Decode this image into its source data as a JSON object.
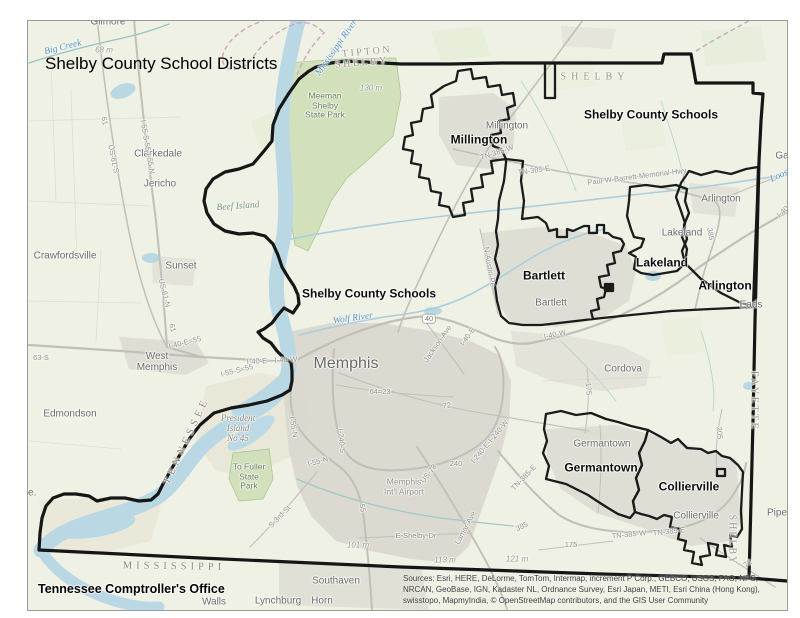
{
  "title": "Shelby County School Districts",
  "attribution": "Tennessee Comptroller's Office",
  "sources": {
    "lines": [
      "Sources: Esri, HERE, DeLorme, TomTom, Intermap, increment P Corp., GEBCO, USGS, FAO, NPS,",
      "NRCAN, GeoBase, IGN, Kadaster NL, Ordnance Survey, Esri Japan, METI, Esri China (Hong Kong),",
      "swisstopo, MapmyIndia, © OpenStreetMap contributors, and the GIS User Community"
    ]
  },
  "colors": {
    "land": "#eef1e4",
    "water": "#b9d8e3",
    "urban": "#d8d5ce",
    "park": "#cfe0b8",
    "boundary": "#161616",
    "road": "#c2bfb8",
    "county_dash": "#c9a8bc",
    "district_label": "#0c0c0c",
    "city_label": "#696967",
    "water_label": "#4d8cba"
  },
  "map": {
    "labels": {
      "districts": [
        {
          "t": "Shelby County Schools",
          "x": 650,
          "y": 114,
          "n": "district-label-shelby-county-schools-north"
        },
        {
          "t": "Millington",
          "x": 478,
          "y": 139,
          "n": "district-label-millington"
        },
        {
          "t": "Bartlett",
          "x": 543,
          "y": 275,
          "n": "district-label-bartlett"
        },
        {
          "t": "Lakeland",
          "x": 661,
          "y": 262,
          "n": "district-label-lakeland"
        },
        {
          "t": "Arlington",
          "x": 724,
          "y": 285,
          "n": "district-label-arlington"
        },
        {
          "t": "Shelby County Schools",
          "x": 368,
          "y": 293,
          "n": "district-label-shelby-county-schools-central"
        },
        {
          "t": "Germantown",
          "x": 600,
          "y": 467,
          "n": "district-label-germantown"
        },
        {
          "t": "Collierville",
          "x": 688,
          "y": 486,
          "n": "district-label-collierville"
        }
      ],
      "cities": [
        {
          "t": "Gilmore",
          "x": 107,
          "y": 21
        },
        {
          "t": "Clarkedale",
          "x": 157,
          "y": 153
        },
        {
          "t": "Jericho",
          "x": 159,
          "y": 183
        },
        {
          "t": "Crawfordsville",
          "x": 64,
          "y": 255
        },
        {
          "t": "Sunset",
          "x": 180,
          "y": 265
        },
        {
          "t": "West\nMemphis",
          "x": 156,
          "y": 361
        },
        {
          "t": "Memphis",
          "x": 345,
          "y": 363,
          "fs": 16,
          "n": "city-label-memphis"
        },
        {
          "t": "Millington",
          "x": 506,
          "y": 125
        },
        {
          "t": "Bartlett",
          "x": 550,
          "y": 302
        },
        {
          "t": "Lakeland",
          "x": 681,
          "y": 232
        },
        {
          "t": "Arlington",
          "x": 720,
          "y": 198
        },
        {
          "t": "Cordova",
          "x": 622,
          "y": 368
        },
        {
          "t": "Germantown",
          "x": 601,
          "y": 443
        },
        {
          "t": "Collierville",
          "x": 695,
          "y": 515
        },
        {
          "t": "Eads",
          "x": 750,
          "y": 304
        },
        {
          "t": "Ga",
          "x": 781,
          "y": 155
        },
        {
          "t": "Pipe",
          "x": 776,
          "y": 512
        },
        {
          "t": "Edmondson",
          "x": 69,
          "y": 413
        },
        {
          "t": "Southaven",
          "x": 335,
          "y": 580
        },
        {
          "t": "Walls",
          "x": 213,
          "y": 601
        },
        {
          "t": "Lynchburg",
          "x": 277,
          "y": 600
        },
        {
          "t": "Horn",
          "x": 321,
          "y": 600
        },
        {
          "t": "lle.",
          "x": 29,
          "y": 492
        }
      ],
      "counties": [
        {
          "t": "TIPTON",
          "x": 366,
          "y": 51,
          "rot": -5,
          "n": "county-label-tipton"
        },
        {
          "t": "SHELBY",
          "x": 361,
          "y": 62,
          "rot": -5,
          "n": "county-label-shelby-nw"
        },
        {
          "t": "SHELBY",
          "x": 594,
          "y": 76,
          "ls": 5,
          "n": "county-label-shelby-top"
        },
        {
          "t": "FAYETTE",
          "x": 753,
          "y": 400,
          "rot": 90,
          "n": "county-label-fayette"
        },
        {
          "t": "SHELBY",
          "x": 731,
          "y": 539,
          "rot": 90,
          "ls": 2,
          "n": "county-label-shelby-se"
        }
      ],
      "states": [
        {
          "t": "TENNESSEE",
          "x": 186,
          "y": 440,
          "rot": -65,
          "n": "state-label-tennessee"
        },
        {
          "t": "MISSISSIPPI",
          "x": 173,
          "y": 566,
          "rot": 1,
          "n": "state-label-mississippi"
        }
      ],
      "water": [
        {
          "t": "Mississippi River",
          "x": 336,
          "y": 47,
          "rot": -55,
          "n": "water-label-mississippi-river"
        },
        {
          "t": "Wolf River",
          "x": 352,
          "y": 318,
          "rot": -8,
          "n": "water-label-wolf-river"
        },
        {
          "t": "Big Creek",
          "x": 62,
          "y": 47,
          "rot": -14,
          "n": "water-label-big-creek"
        },
        {
          "t": "Loosahat",
          "x": 786,
          "y": 172,
          "rot": -25,
          "n": "water-label-loosahatchie"
        }
      ],
      "green": [
        {
          "t": "Beef Island",
          "x": 237,
          "y": 206,
          "rot": -4,
          "n": "area-label-beef-island"
        }
      ],
      "parks": [
        {
          "t": "Meeman\nShelby\nState Park",
          "x": 324,
          "y": 105,
          "n": "park-label-meeman-shelby"
        },
        {
          "t": "To Fuller\nState\nPark",
          "x": 248,
          "y": 476,
          "n": "park-label-to-fuller"
        }
      ],
      "islands": [
        {
          "t": "President\nIsland\nNo 45",
          "x": 237,
          "y": 427,
          "n": "island-label-president-island"
        }
      ],
      "airports": [
        {
          "t": "Memphis\nInt'l Airport",
          "x": 403,
          "y": 486,
          "n": "airport-label-memphis-intl"
        }
      ],
      "elevations": [
        {
          "t": "68 m",
          "x": 103,
          "y": 50
        },
        {
          "t": "130 m",
          "x": 370,
          "y": 88
        },
        {
          "t": "101 m",
          "x": 357,
          "y": 545
        },
        {
          "t": "113 m",
          "x": 444,
          "y": 560
        },
        {
          "t": "121 m",
          "x": 516,
          "y": 559
        }
      ],
      "roads": [
        {
          "t": "61",
          "x": 103,
          "y": 120,
          "rot": 78
        },
        {
          "t": "US-61-S",
          "x": 112,
          "y": 158,
          "rot": 78
        },
        {
          "t": "I-55-S-55-I-55-N",
          "x": 146,
          "y": 146,
          "rot": 80
        },
        {
          "t": "US-61-N",
          "x": 163,
          "y": 292,
          "rot": 76
        },
        {
          "t": "61",
          "x": 171,
          "y": 327,
          "rot": 76
        },
        {
          "t": "I-40-E=55",
          "x": 184,
          "y": 342,
          "rot": -14
        },
        {
          "t": "I-55-S=55",
          "x": 236,
          "y": 370,
          "rot": -14
        },
        {
          "t": "I-40-E—I-40-W",
          "x": 271,
          "y": 360,
          "rot": -3
        },
        {
          "t": "63-S",
          "x": 40,
          "y": 357
        },
        {
          "t": "Jackson-Ave",
          "x": 437,
          "y": 343,
          "rot": -55
        },
        {
          "t": "I-40-E",
          "x": 467,
          "y": 336,
          "rot": -55
        },
        {
          "t": "I-40-W",
          "x": 554,
          "y": 334,
          "rot": -12
        },
        {
          "t": "N-Austin-Pe",
          "x": 488,
          "y": 266,
          "rot": 80
        },
        {
          "t": "TN-385-W",
          "x": 496,
          "y": 152,
          "rot": -18
        },
        {
          "t": "TN-385-E",
          "x": 533,
          "y": 170,
          "rot": -8
        },
        {
          "t": "Paul-W-Barrett-Memorial-Hwy",
          "x": 636,
          "y": 176,
          "rot": -7
        },
        {
          "t": "385",
          "x": 709,
          "y": 233,
          "rot": 80
        },
        {
          "t": "I-40",
          "x": 782,
          "y": 211,
          "rot": -40
        },
        {
          "t": "64=23",
          "x": 379,
          "y": 391
        },
        {
          "t": "72",
          "x": 446,
          "y": 405,
          "rot": -8
        },
        {
          "t": "I-240-S",
          "x": 340,
          "y": 440,
          "rot": 85
        },
        {
          "t": "I-55-N",
          "x": 292,
          "y": 426,
          "rot": 80
        },
        {
          "t": "I-55-N",
          "x": 317,
          "y": 461,
          "rot": -16
        },
        {
          "t": "55",
          "x": 361,
          "y": 507,
          "rot": 80
        },
        {
          "t": "S-3rd-St",
          "x": 279,
          "y": 516,
          "rot": -46
        },
        {
          "t": "US-78",
          "x": 428,
          "y": 473,
          "rot": -52
        },
        {
          "t": "240",
          "x": 455,
          "y": 463
        },
        {
          "t": "I-240-E-I-240-W",
          "x": 489,
          "y": 441,
          "rot": -50
        },
        {
          "t": "TN-385-E",
          "x": 523,
          "y": 477,
          "rot": -46
        },
        {
          "t": "Lamar-Ave",
          "x": 465,
          "y": 527,
          "rot": -62
        },
        {
          "t": "E-Shelby-Dr",
          "x": 415,
          "y": 535
        },
        {
          "t": "385",
          "x": 521,
          "y": 526,
          "rot": -24
        },
        {
          "t": "TN-385-W",
          "x": 628,
          "y": 534,
          "rot": -6
        },
        {
          "t": "TN-385-E",
          "x": 668,
          "y": 531,
          "rot": -6
        },
        {
          "t": "175",
          "x": 570,
          "y": 544
        },
        {
          "t": "175",
          "x": 587,
          "y": 388,
          "rot": 85
        },
        {
          "t": "205",
          "x": 718,
          "y": 432,
          "rot": 85
        },
        {
          "t": "72",
          "x": 747,
          "y": 563,
          "rot": -35
        }
      ],
      "shields": [
        {
          "t": "40",
          "x": 428,
          "y": 318,
          "n": "road-shield-40"
        }
      ]
    }
  }
}
